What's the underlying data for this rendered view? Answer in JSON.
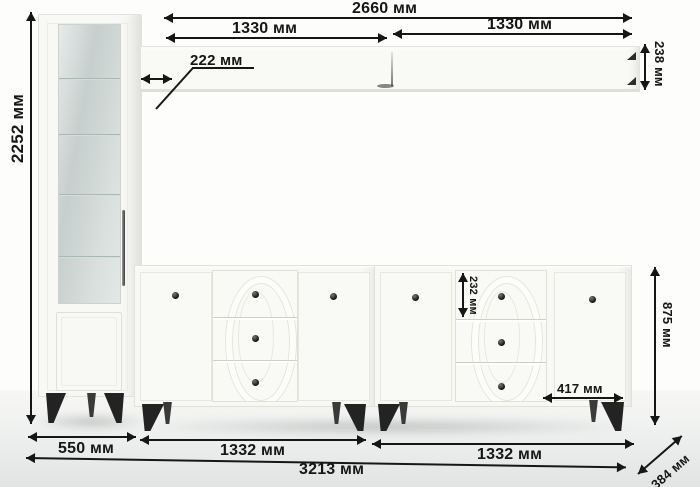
{
  "diagram": {
    "type": "furniture-dimension-diagram",
    "unit": "мм",
    "labels": {
      "shelf_total": "2660 мм",
      "shelf_left": "1330 мм",
      "shelf_right": "1330 мм",
      "shelf_depth": "222 мм",
      "shelf_height": "238 мм",
      "cabinet_height": "2252 мм",
      "cabinet_width": "550 мм",
      "sideboard_left_width": "1332 мм",
      "sideboard_right_width": "1332 мм",
      "total_width": "3213 мм",
      "sideboard_height": "875 мм",
      "drawer_height": "232 мм",
      "door_width": "417 мм",
      "depth": "384 мм"
    },
    "colors": {
      "dimension_line": "#161616",
      "furniture_white": "#f8f8f5",
      "glass": "#ccd6d3",
      "hardware_black": "#232323",
      "floor": "#e6e8e7"
    }
  }
}
